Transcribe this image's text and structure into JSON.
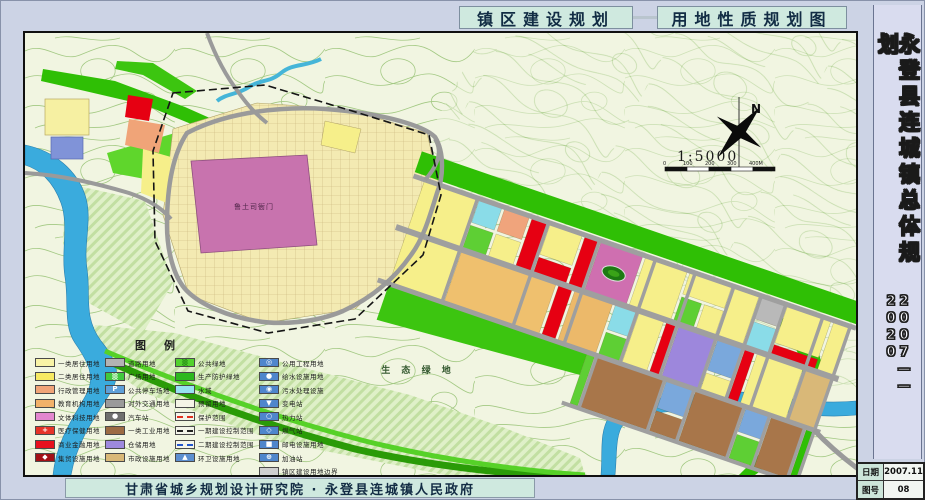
{
  "header": {
    "title_left": "镇区建设规划",
    "title_right": "用地性质规划图"
  },
  "sidebar": {
    "title": "永登县连城镇总体规划",
    "years": "2007——2020"
  },
  "footer": {
    "credit": "甘肃省城乡规划设计研究院 · 永登县连城镇人民政府"
  },
  "titleblock": {
    "date_label": "日期",
    "date_value": "2007.11",
    "sheet_label": "图号",
    "sheet_value": "08"
  },
  "map": {
    "labels": {
      "north": "N",
      "scale": "1:5000",
      "eco": "生 态 绿 地",
      "historic": "鲁土司衙门"
    },
    "scale_ticks": [
      "0",
      "100",
      "200",
      "300",
      "400M"
    ]
  },
  "legend": {
    "title": "图例",
    "columns": [
      [
        {
          "label": "一类居住用地",
          "sw": {
            "bg": "#f8f3a6"
          }
        },
        {
          "label": "二类居住用地",
          "sw": {
            "bg": "#f7ea62"
          }
        },
        {
          "label": "行政管理用地",
          "sw": {
            "bg": "#f0a478"
          }
        },
        {
          "label": "教育机构用地",
          "sw": {
            "bg": "#f2b26a"
          }
        },
        {
          "label": "文体科技用地",
          "sw": {
            "bg": "#e387cf"
          }
        },
        {
          "label": "医疗保健用地",
          "sw": {
            "bg": "#e63329",
            "glyph": "+"
          }
        },
        {
          "label": "商业金融用地",
          "sw": {
            "bg": "#e8101e"
          }
        },
        {
          "label": "集贸设施用地",
          "sw": {
            "bg": "#a31016",
            "glyph": "◆"
          }
        }
      ],
      [
        {
          "label": "道路用地",
          "sw": {
            "bg": "#b3b3b3"
          }
        },
        {
          "label": "广场用地",
          "sw": {
            "bg": "#41c93e",
            "glyph": "▒"
          }
        },
        {
          "label": "公共停车场地",
          "sw": {
            "bg": "#5ea0d8",
            "glyph": "P"
          }
        },
        {
          "label": "对外交通用地",
          "sw": {
            "bg": "#9a9a9a"
          }
        },
        {
          "label": "汽车站",
          "sw": {
            "bg": "#6f6f6f",
            "glyph": "●"
          }
        },
        {
          "label": "一类工业用地",
          "sw": {
            "bg": "#9c6b44"
          }
        },
        {
          "label": "仓储用地",
          "sw": {
            "bg": "#9d89de"
          }
        },
        {
          "label": "市政设施用地",
          "sw": {
            "bg": "#d9b878"
          }
        }
      ],
      [
        {
          "label": "公共绿地",
          "sw": {
            "bg": "#52d22e",
            "glyph": "▒",
            "fg": "#1c7a10"
          }
        },
        {
          "label": "生产防护绿地",
          "sw": {
            "bg": "#2db81e"
          }
        },
        {
          "label": "水域",
          "sw": {
            "bg": "#97e2f2"
          }
        },
        {
          "label": "预留用地",
          "sw": {
            "bg": "#f4f4e6"
          }
        },
        {
          "label": "保护范围",
          "sw": {
            "type": "line",
            "color": "#e03020",
            "style": "dashed"
          }
        },
        {
          "label": "一期建设控制范围",
          "sw": {
            "type": "line",
            "color": "#222222",
            "style": "dashdot"
          }
        },
        {
          "label": "二期建设控制范围",
          "sw": {
            "type": "line",
            "color": "#2255cc",
            "style": "dashed"
          }
        },
        {
          "label": "环卫设施用地",
          "sw": {
            "bg": "#5d8fd0",
            "glyph": "▲"
          }
        }
      ],
      [
        {
          "label": "公用工程用地",
          "sw": {
            "bg": "#4f86cc",
            "glyph": "◎"
          }
        },
        {
          "label": "给水设施用地",
          "sw": {
            "bg": "#4f86cc",
            "glyph": "●"
          }
        },
        {
          "label": "污水处理设施",
          "sw": {
            "bg": "#4f86cc",
            "glyph": "◉"
          }
        },
        {
          "label": "变电站",
          "sw": {
            "bg": "#4f86cc",
            "glyph": "▼"
          }
        },
        {
          "label": "热力站",
          "sw": {
            "bg": "#4f86cc",
            "glyph": "○"
          }
        },
        {
          "label": "燃气站",
          "sw": {
            "bg": "#4f86cc",
            "glyph": "◇"
          }
        },
        {
          "label": "邮电设施用地",
          "sw": {
            "bg": "#4f86cc",
            "glyph": "■"
          }
        },
        {
          "label": "加油站",
          "sw": {
            "bg": "#4f86cc",
            "glyph": "⊕"
          }
        },
        {
          "label": "镇区建设用地边界",
          "sw": {
            "bg": "#cfcfcf"
          }
        }
      ]
    ]
  }
}
